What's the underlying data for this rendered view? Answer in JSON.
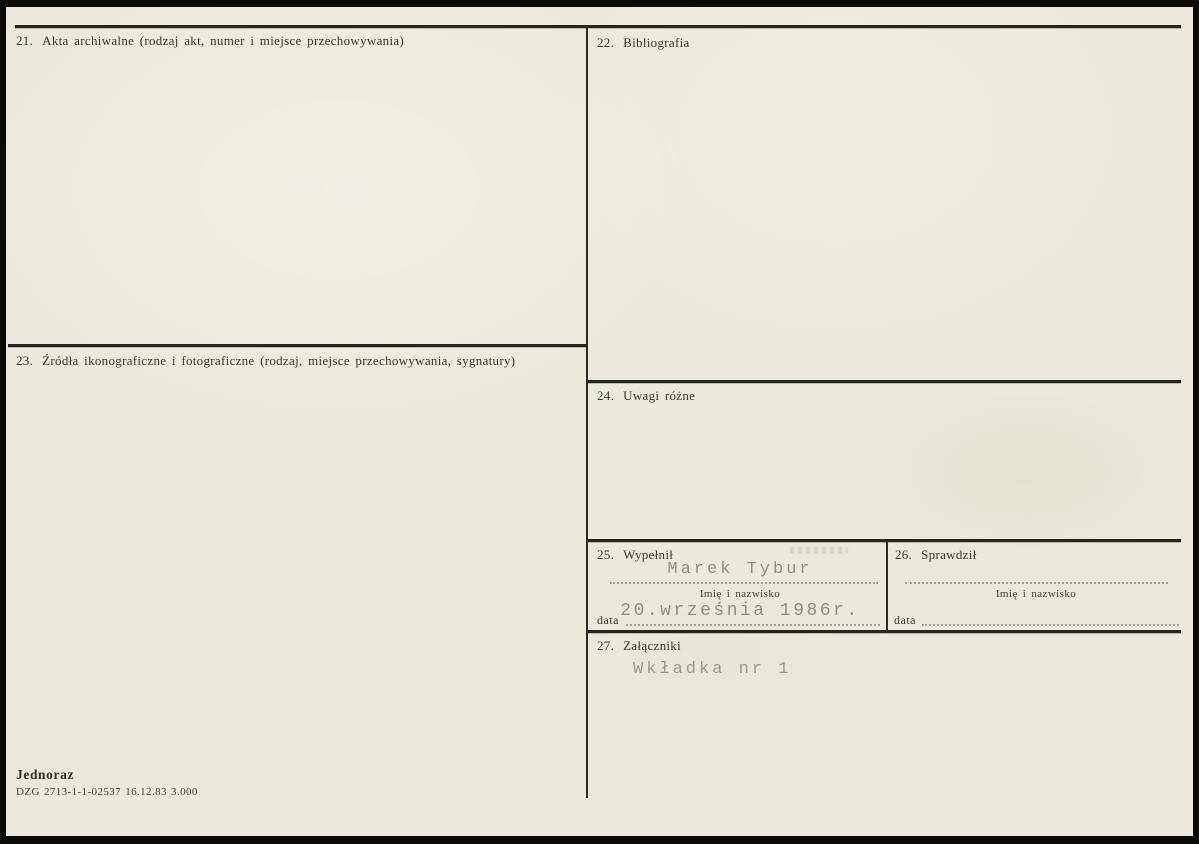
{
  "palette": {
    "paper": "#ece9dc",
    "line": "#26251f",
    "print_text": "#3a382d",
    "typed_text": "#8e9088"
  },
  "fields": {
    "f21": {
      "number": "21.",
      "title": "Akta archiwalne (rodzaj akt, numer i miejsce przechowywania)"
    },
    "f22": {
      "number": "22.",
      "title": "Bibliografia"
    },
    "f23": {
      "number": "23.",
      "title": "Źródła ikonograficzne i fotograficzne (rodzaj, miejsce przechowywania, sygnatury)"
    },
    "f24": {
      "number": "24.",
      "title": "Uwagi różne"
    },
    "f25": {
      "number": "25.",
      "title": "Wypełnił",
      "name_value": "Marek Tybur",
      "name_caption": "Imię i nazwisko",
      "date_label": "data",
      "date_value": "20.września 1986r."
    },
    "f26": {
      "number": "26.",
      "title": "Sprawdził",
      "name_value": "",
      "name_caption": "Imię i nazwisko",
      "date_label": "data",
      "date_value": ""
    },
    "f27": {
      "number": "27.",
      "title": "Załączniki",
      "value": "Wkładka nr 1"
    }
  },
  "footer": {
    "form_name": "Jednoraz",
    "print_code": "DZG 2713-1-1-02537 16.12.83 3.000"
  }
}
